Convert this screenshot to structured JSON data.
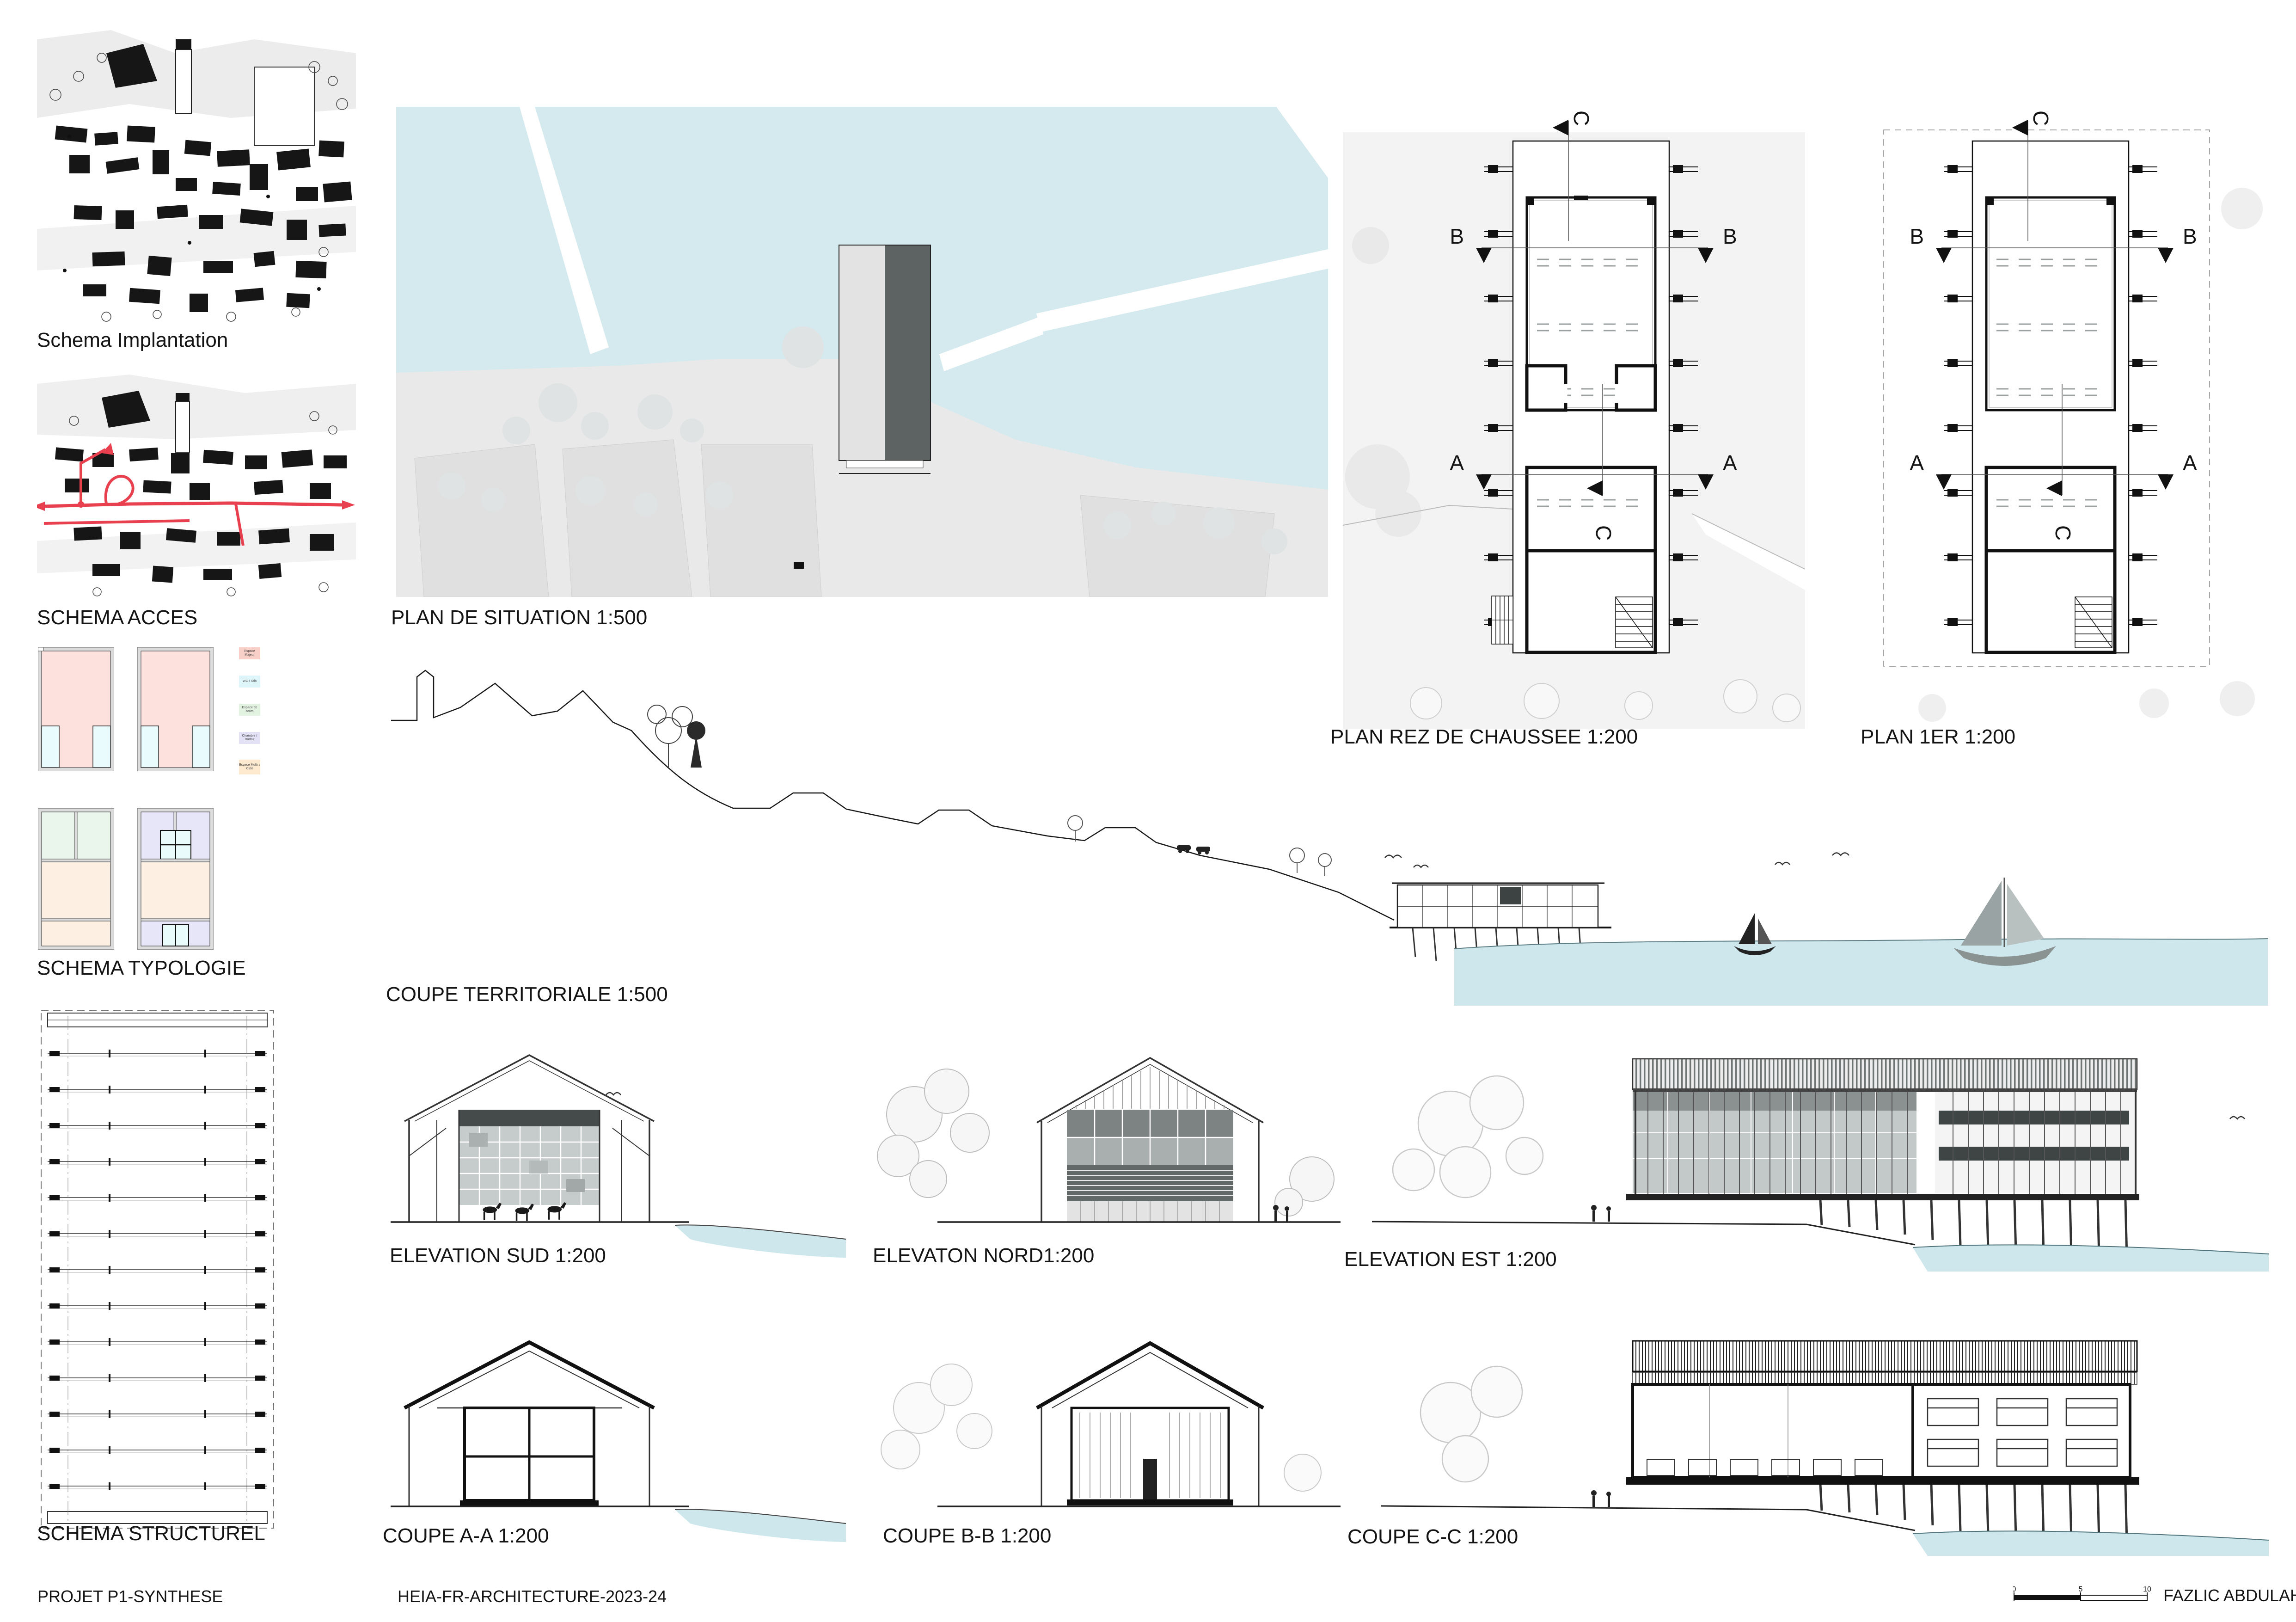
{
  "colors": {
    "water": "#d4eaee",
    "water_section": "#cde7ec",
    "land": "#e9e9e9",
    "building_light": "#e3e3e3",
    "building_dark": "#5d6363",
    "access_route_red": "#e8404f",
    "wall_gray": "#dcdcdc"
  },
  "panels": {
    "implantation": {
      "label": "Schema Implantation"
    },
    "acces": {
      "label": "SCHEMA ACCES"
    },
    "typologie": {
      "label": "SCHEMA TYPOLOGIE",
      "legend": [
        {
          "label": "Espace Majeur",
          "color": "#f9d0c8"
        },
        {
          "label": "WC / Sdb",
          "color": "#def5fa"
        },
        {
          "label": "Espace de cours",
          "color": "#e2f3e2"
        },
        {
          "label": "Chambre / Dortoir",
          "color": "#e2e1f6"
        },
        {
          "label": "Espace Multi. / Café",
          "color": "#fdeacf"
        }
      ]
    },
    "structurel": {
      "label": "SCHEMA STRUCTUREL"
    },
    "situation": {
      "label": "PLAN DE SITUATION 1:500"
    },
    "plan_rdc": {
      "label": "PLAN REZ DE CHAUSSEE 1:200"
    },
    "plan_1er": {
      "label": "PLAN 1ER 1:200"
    },
    "coupe_territoriale": {
      "label": "COUPE TERRITORIALE 1:500"
    },
    "elevation_sud": {
      "label": "ELEVATION SUD 1:200"
    },
    "elevation_nord": {
      "label": "ELEVATON NORD1:200"
    },
    "elevation_est": {
      "label": "ELEVATION EST 1:200"
    },
    "coupe_aa": {
      "label": "COUPE A-A 1:200"
    },
    "coupe_bb": {
      "label": "COUPE B-B 1:200"
    },
    "coupe_cc": {
      "label": "COUPE C-C 1:200"
    }
  },
  "markers": {
    "a": "A",
    "b": "B",
    "c": "C"
  },
  "scalebar": {
    "ticks": [
      "0",
      "5",
      "10"
    ]
  },
  "footer": {
    "project": "PROJET P1-SYNTHESE",
    "course": "HEIA-FR-ARCHITECTURE-2023-24",
    "author": "FAZLIC ABDULAH"
  }
}
